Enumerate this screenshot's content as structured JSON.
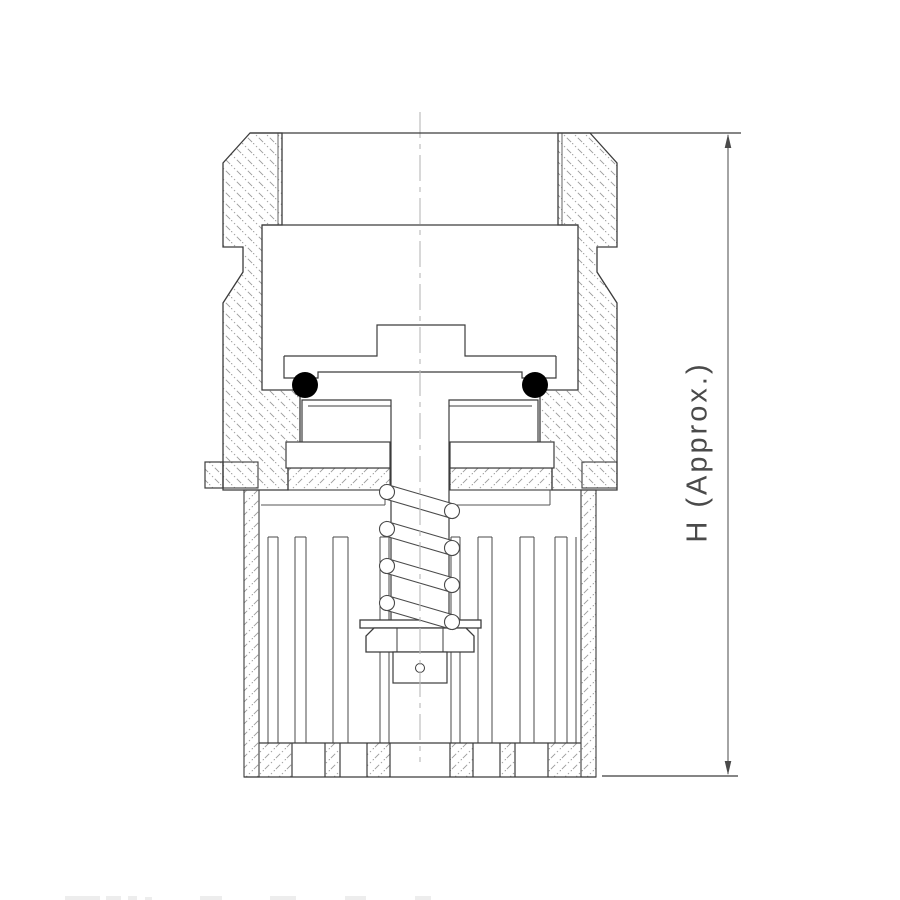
{
  "drawing": {
    "type": "engineering-cross-section",
    "subject": "cartridge check valve assembly, sectional elevation",
    "dimension": {
      "label": "H (Approx.)",
      "orientation": "vertical",
      "arrows": [
        "up-arrow",
        "down-arrow"
      ]
    },
    "components": {
      "body": "hatched outer valve body with chamfered top cap and thread undercut",
      "cage": "slotted lower cup / cage with bottom band",
      "stem": "T-shaped poppet stem",
      "o_rings": {
        "count": 2,
        "style": "solid-black-circles"
      },
      "spring": {
        "coil_count": 4,
        "style": "inclined tube coils with round ends"
      },
      "washer": "flat spring seat washer",
      "hex_nut": "hex nut with chamfered corners and facet lines",
      "slot_count_visible": 9
    },
    "colors": {
      "background": "#ffffff",
      "line": "#3c3c3c",
      "thin_line": "#555555",
      "hatch": "#9a9a9a",
      "centerline": "#b8b8b8",
      "o_ring_fill": "#000000",
      "label_text": "#4a4a4a"
    }
  }
}
